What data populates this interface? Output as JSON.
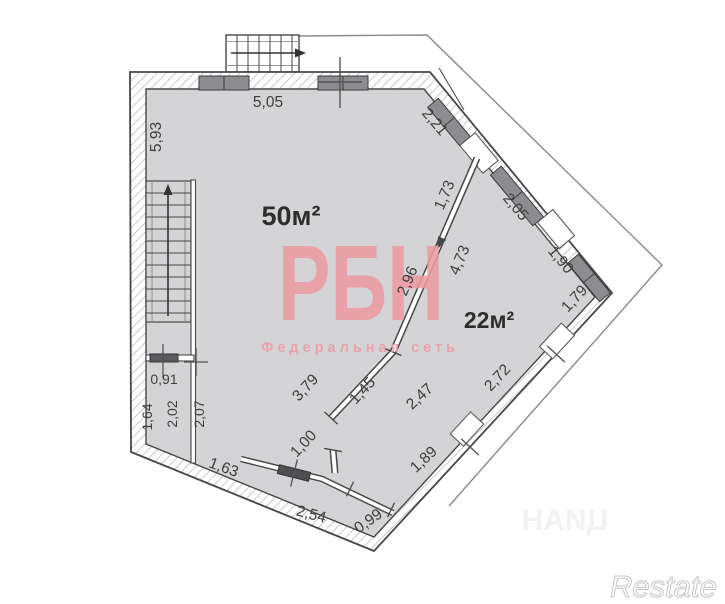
{
  "plan": {
    "rooms": {
      "main": "50м²",
      "second": "22м²"
    },
    "dimensions": {
      "top_wall": "5,05",
      "left_wall": "5,93",
      "ne_wall_1": "2,21",
      "ne_wall_2": "2,05",
      "ne_wall_3": "1,90",
      "east_wall_1": "1,79",
      "east_wall_2": "2,72",
      "partition_1": "1,73",
      "partition_right": "4,73",
      "partition_left": "2,96",
      "partition_lower": "3,79",
      "partition_seg": "1,45",
      "room2_side": "2,47",
      "door_width": "1,00",
      "room2_bottom": "1,89",
      "corridor": "2,54",
      "corridor_door": "0,99",
      "sw_wall": "1,63",
      "closet_width": "0,91",
      "closet_left": "1,64",
      "closet_height": "2,02",
      "room_side": "2,07"
    }
  },
  "watermarks": {
    "brand": "РБН",
    "network": "Федеральная сеть",
    "restate": "Restate",
    "cian": "ЦИАН"
  },
  "colors": {
    "room_fill": "#d4d4d6",
    "wall_outline": "#474747",
    "window_fill": "#8d8d91",
    "brand_pink": "#ec9ba5"
  }
}
